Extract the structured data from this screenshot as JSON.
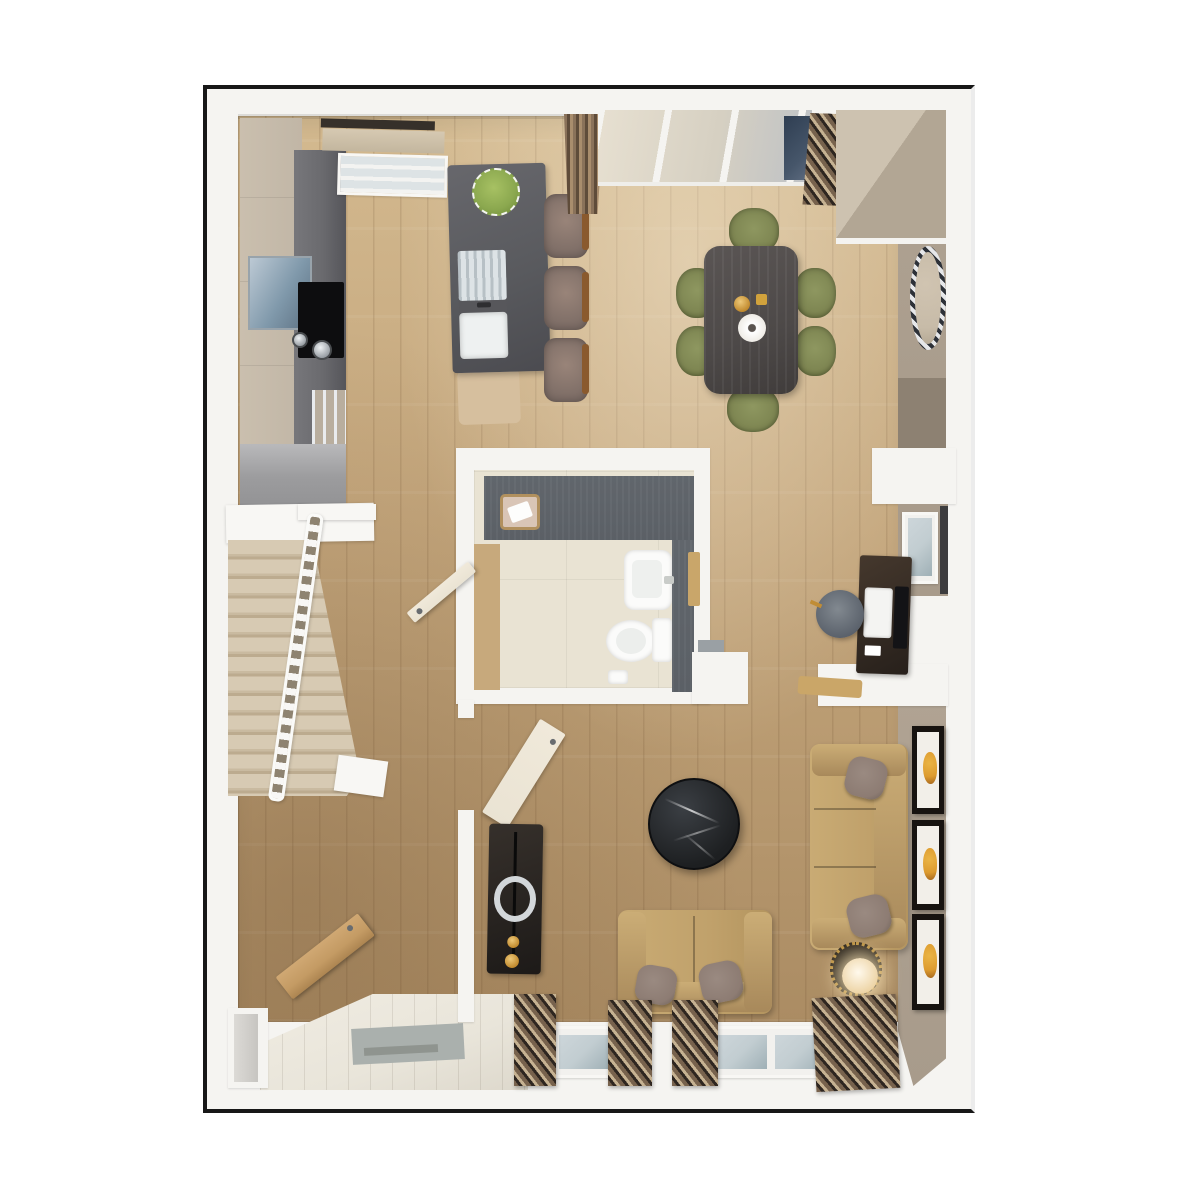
{
  "title": "3D Floor Plan — Open-Plan Ground Floor",
  "palette": {
    "page-bg": "#ffffff",
    "wall": "#f5f4f1",
    "outline": "#171717",
    "wood-light": "#d3b98f",
    "wood-base": "#c4a67c",
    "wood-dark": "#ab8c63",
    "tile": "#e9e5da",
    "taupe-wall": "#a89b8b",
    "taupe-dark": "#8d8172",
    "island": "#595a5e",
    "counter": "#6a6a6e",
    "cabinet-beige": "#c1b6a6",
    "cabinet-gray": "#9c9c9e",
    "sofa": "#c0a16b",
    "sofa-dark": "#a8895b",
    "pillow": "#8d7c73",
    "chair-olive": "#7e8652",
    "table-wood": "#4d4948",
    "marble-black": "#1d1f21",
    "blind-stripe-a": "#77624d",
    "blind-stripe-b": "#2e2620",
    "blind-stripe-c": "#c6b292",
    "carpet": "#d7cab3",
    "door-wood": "#c49b64",
    "door-cream": "#eae3d3",
    "art-amber": "#dd9b2f",
    "plant-green": "#8ba84f",
    "slate": "#5b6066",
    "bath-floor": "#e9e3d3",
    "glass": "#c2cdd1",
    "glass-dark": "#46566a"
  },
  "rooms": {
    "kitchen": {
      "label": "Kitchen"
    },
    "dining": {
      "label": "Dining area"
    },
    "living": {
      "label": "Living room"
    },
    "bathroom": {
      "label": "WC / cloakroom"
    },
    "hall": {
      "label": "Hallway"
    },
    "entry": {
      "label": "Entrance"
    },
    "stairs": {
      "label": "Carpeted staircase"
    },
    "study": {
      "label": "Study nook"
    }
  },
  "furniture": {
    "island": {
      "label": "Kitchen island with sink and plant"
    },
    "bar_stools": {
      "label": "Bar stools"
    },
    "cooktop": {
      "label": "Cooktop with pans"
    },
    "oven": {
      "label": "Built-in appliance"
    },
    "dining_table": {
      "label": "Dining table with vase and tray"
    },
    "dining_chairs": {
      "label": "Olive dining chairs"
    },
    "sideboard": {
      "label": "Sideboard"
    },
    "mirror": {
      "label": "Round wall mirror"
    },
    "basin": {
      "label": "Wash basin"
    },
    "toilet": {
      "label": "Toilet"
    },
    "laundry_basket": {
      "label": "Wicker basket"
    },
    "desk": {
      "label": "Desk with monitor"
    },
    "desk_stool": {
      "label": "Upholstered stool"
    },
    "sofa_right": {
      "label": "Three-seat sofa"
    },
    "sofa_bottom": {
      "label": "Two-seat sofa"
    },
    "coffee_table": {
      "label": "Round black marble coffee table"
    },
    "side_table": {
      "label": "Side table with glowing lamp"
    },
    "tv_console": {
      "label": "Media console with ring sculpture"
    },
    "wall_art": {
      "label": "Framed amber artwork"
    },
    "front_door": {
      "label": "Open front door"
    },
    "living_door": {
      "label": "Open living-room door"
    },
    "wc_door": {
      "label": "Open WC door"
    },
    "kitchen_window": {
      "label": "Kitchen window with roman shade"
    },
    "patio_door": {
      "label": "Glazed patio door"
    },
    "curtain": {
      "label": "Drapery panel"
    },
    "blinds": {
      "label": "Striped blind bundle"
    },
    "stair_railing": {
      "label": "White spindle railing"
    }
  },
  "counts": {
    "bar_stools": 3,
    "dining_chairs": 6,
    "art_frames": 3,
    "bottom_blind_bundles": 4,
    "stair_steps": 13
  }
}
